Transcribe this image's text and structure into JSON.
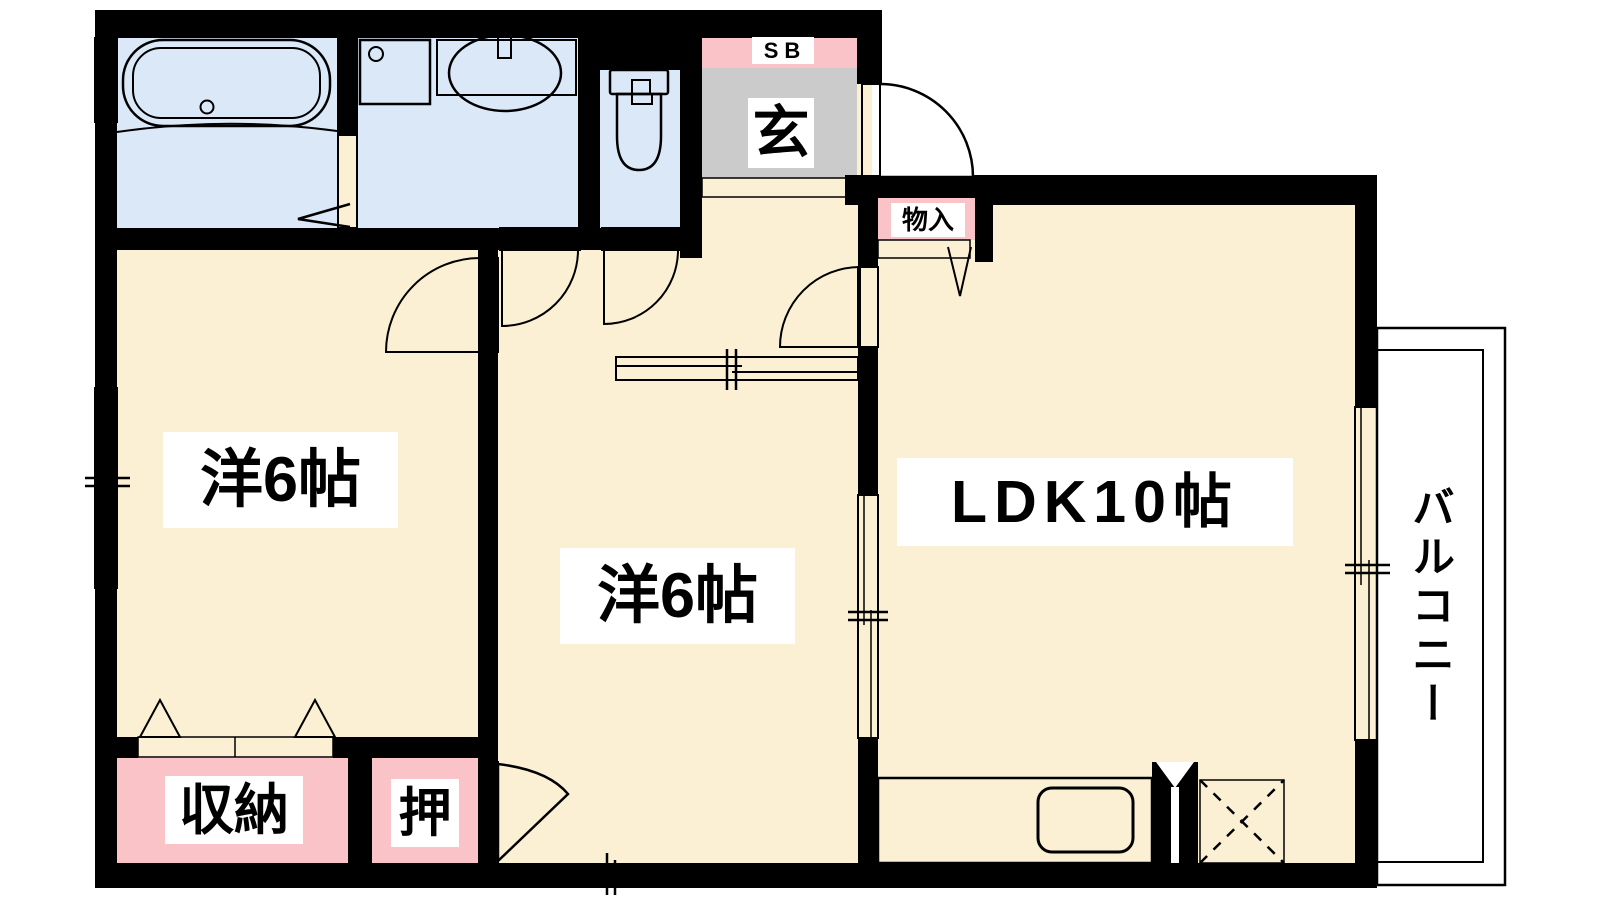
{
  "title": "apartment-floor-plan",
  "colors": {
    "wall": "#000000",
    "room_fill": "#fbf0d3",
    "wet_fill": "#dae8f8",
    "closet_fill": "#f9c3c8",
    "genkan_fill": "#cbcbcb",
    "kitchen_fill": "#e7dcf3",
    "balcony_fill": "#cbcbcb",
    "label_bg": "#ffffff"
  },
  "labels": {
    "room_left": "洋6帖",
    "room_center": "洋6帖",
    "ldk": "LDK10帖",
    "balcony": "バルコニー",
    "entrance": "玄",
    "shoe_box": "SB",
    "storage_compartment": "物入",
    "storage": "収納",
    "closet": "押"
  }
}
